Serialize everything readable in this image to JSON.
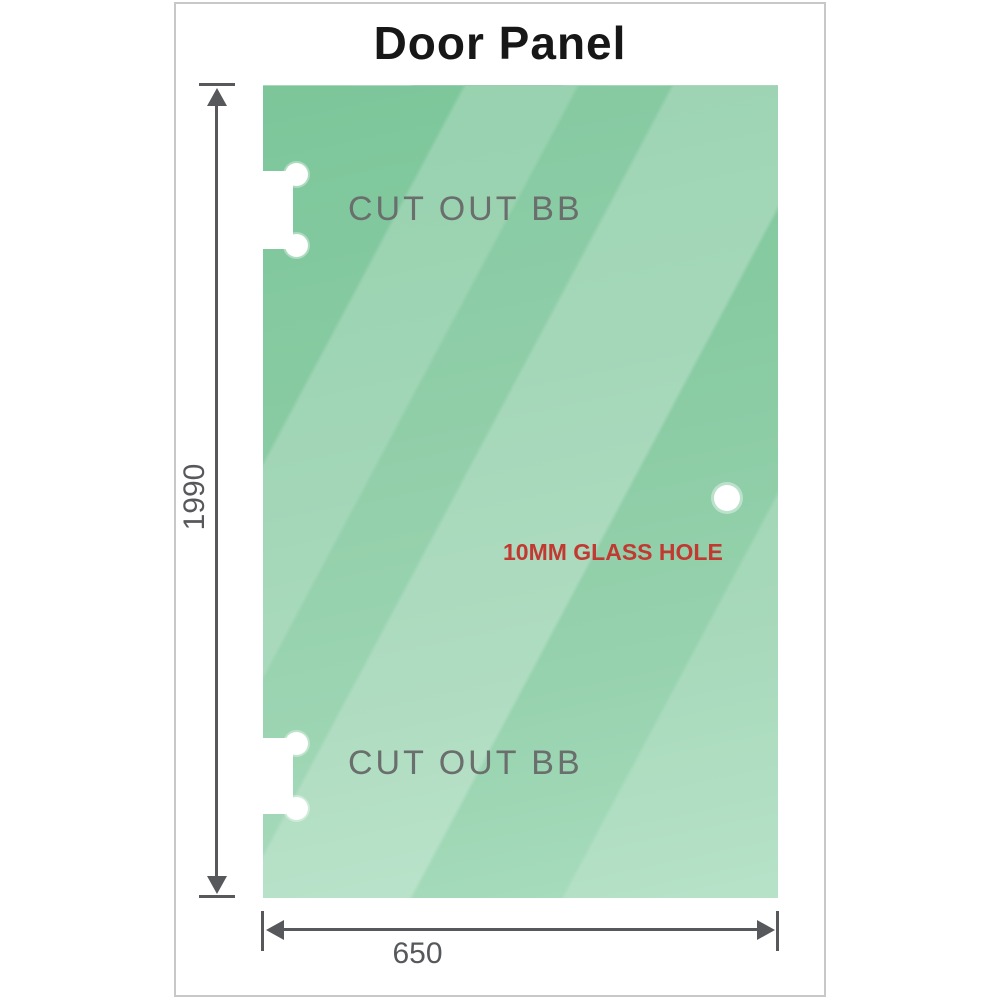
{
  "title": "Door Panel",
  "panel": {
    "cutouts": [
      {
        "label": "CUT OUT BB"
      },
      {
        "label": "CUT OUT BB"
      }
    ],
    "hole_label": "10MM GLASS HOLE"
  },
  "dimensions": {
    "height": "1990",
    "width": "650"
  },
  "colors": {
    "glass_base": "#89cba3",
    "glass_dark": "#7cc69a",
    "glass_light": "#a9ddbe",
    "dimension_gray": "#57585c",
    "cutout_label_gray": "#6a6e6c",
    "hole_label_red": "#c23932",
    "frame_border_gray": "#c8c8c8",
    "title_black": "#171717"
  }
}
